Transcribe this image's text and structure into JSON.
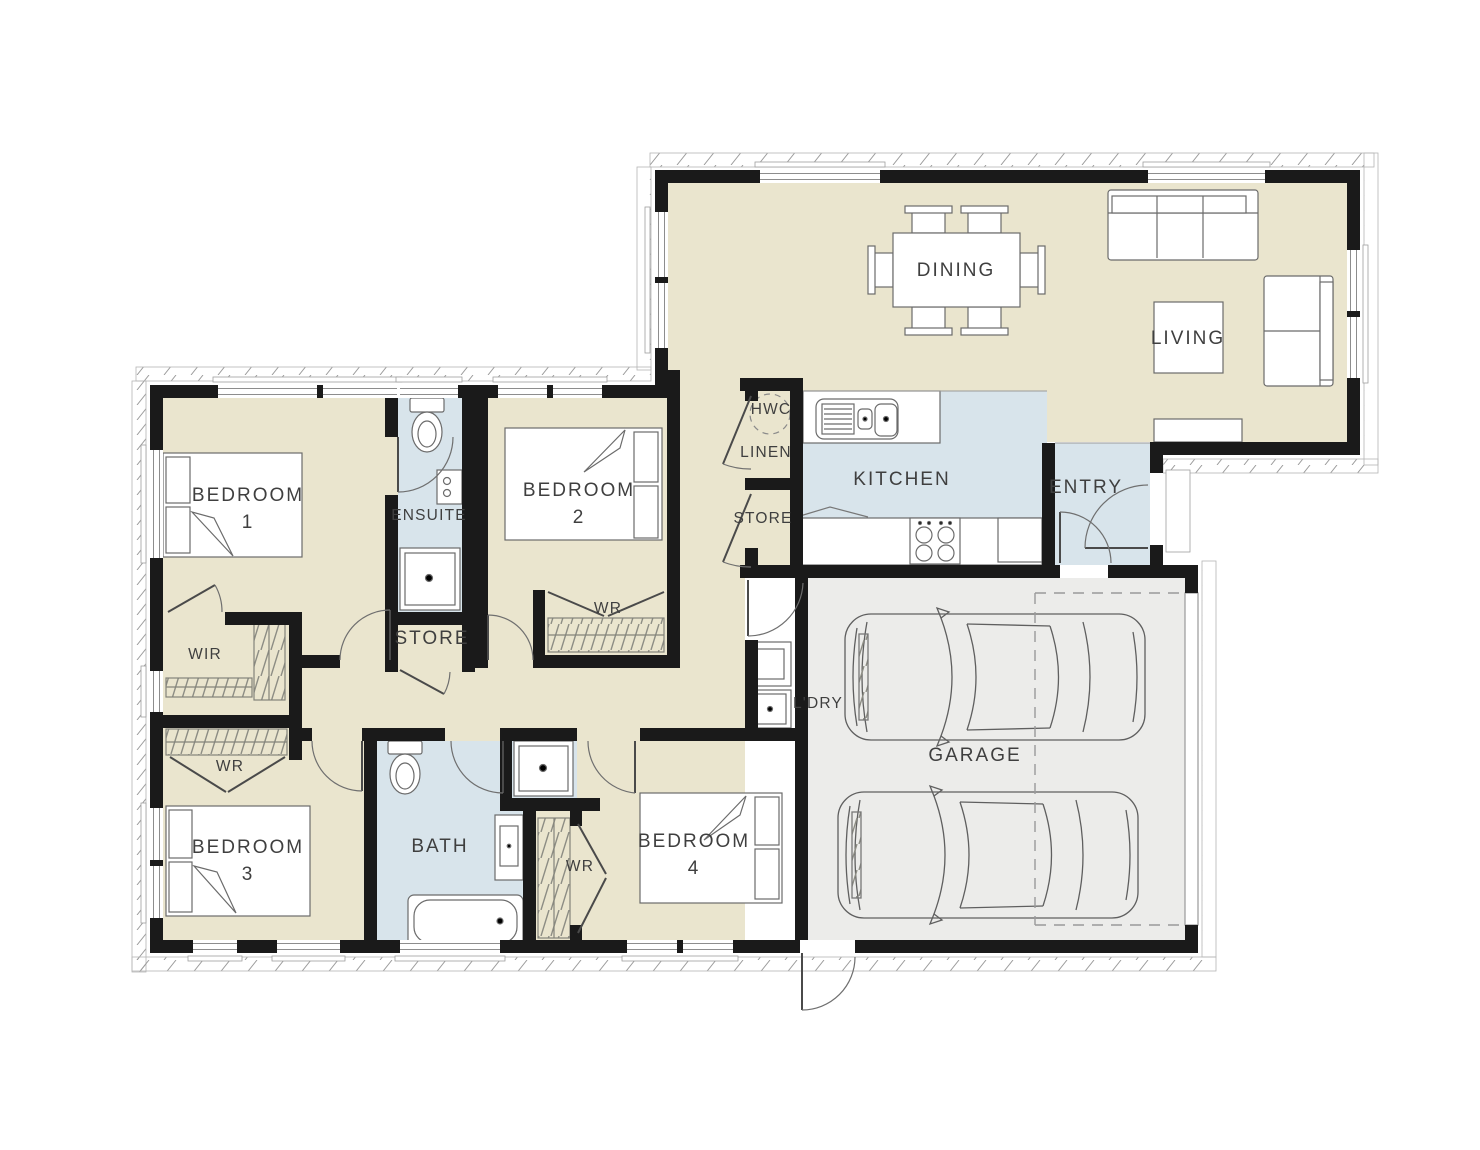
{
  "title": "4 Bedroom House Floor Plan",
  "colors": {
    "floor_beige": "#EAE5CE",
    "wet_blue": "#D8E4EB",
    "garage_grey": "#ECECEA",
    "wall": "#1A1A1A",
    "furniture_line": "#6B6B6B",
    "label_text": "#3F3F3F"
  },
  "rooms": [
    {
      "name": "dining",
      "label": "DINING"
    },
    {
      "name": "living",
      "label": "LIVING"
    },
    {
      "name": "kitchen",
      "label": "KITCHEN"
    },
    {
      "name": "entry",
      "label": "ENTRY"
    },
    {
      "name": "hwc",
      "label": "HWC"
    },
    {
      "name": "linen",
      "label": "LINEN"
    },
    {
      "name": "store-hall",
      "label": "STORE"
    },
    {
      "name": "bedroom-1",
      "label": "BEDROOM",
      "number": "1"
    },
    {
      "name": "ensuite",
      "label": "ENSUITE"
    },
    {
      "name": "bedroom-2",
      "label": "BEDROOM",
      "number": "2"
    },
    {
      "name": "wr-bedroom-2",
      "label": "WR"
    },
    {
      "name": "store-middle",
      "label": "STORE"
    },
    {
      "name": "wir",
      "label": "WIR"
    },
    {
      "name": "wr-left",
      "label": "WR"
    },
    {
      "name": "bedroom-3",
      "label": "BEDROOM",
      "number": "3"
    },
    {
      "name": "bath",
      "label": "BATH"
    },
    {
      "name": "wr-centre",
      "label": "WR"
    },
    {
      "name": "bedroom-4",
      "label": "BEDROOM",
      "number": "4"
    },
    {
      "name": "laundry",
      "label": "L'DRY"
    },
    {
      "name": "garage",
      "label": "GARAGE"
    }
  ]
}
